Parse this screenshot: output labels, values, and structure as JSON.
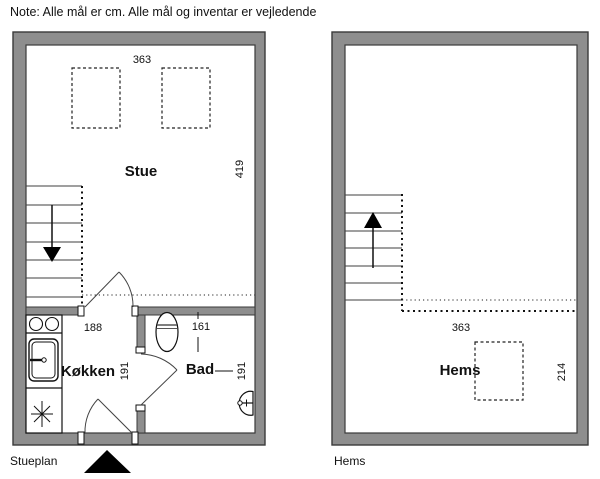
{
  "note": "Note: Alle mål er cm. Alle mål og inventar er vejledende",
  "colors": {
    "wall_fill": "#8e8e8e",
    "wall_stroke": "#3a3a3a",
    "line": "#1a1a1a",
    "background": "#ffffff"
  },
  "ground_floor": {
    "caption": "Stueplan",
    "rooms": {
      "living": "Stue",
      "kitchen": "Køkken",
      "bath": "Bad"
    },
    "dimensions": {
      "top_width": "363",
      "right_height": "419",
      "kitchen_width": "188",
      "kitchen_depth": "191",
      "bath_width": "161",
      "bath_depth": "191"
    },
    "symbols": [
      "stairs-down",
      "entrance-arrow",
      "cooktop",
      "sink",
      "appliance",
      "toilet",
      "washbasin",
      "furniture-outline"
    ]
  },
  "loft": {
    "caption": "Hems",
    "room_label": "Hems",
    "dimensions": {
      "open_width": "363",
      "depth": "214"
    },
    "symbols": [
      "stairs-up",
      "furniture-outline"
    ]
  }
}
